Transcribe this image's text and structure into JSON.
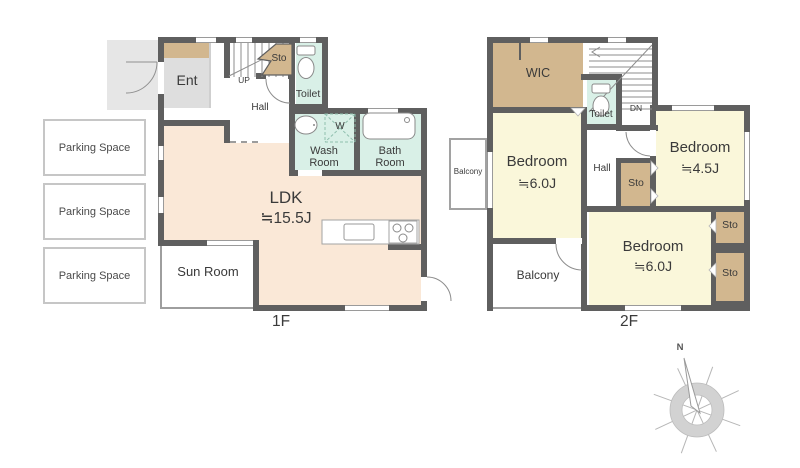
{
  "colors": {
    "wall": "#5f5f5f",
    "ldk": "#fae8d7",
    "bedroom": "#faf7da",
    "storage": "#d2b78f",
    "wet": "#d9f0e7",
    "ent": "#dedede",
    "porch": "#e6e6e6"
  },
  "floor1": {
    "label": "1F",
    "parking": [
      "Parking Space",
      "Parking Space",
      "Parking Space"
    ],
    "rooms": {
      "ent": "Ent",
      "storage": "Sto",
      "toilet": "Toilet",
      "hall": "Hall",
      "stairs_up": "UP",
      "washer": "W",
      "wash_room": "Wash\nRoom",
      "bath_room": "Bath\nRoom",
      "ldk_name": "LDK",
      "ldk_size": "≒15.5J",
      "sun_room": "Sun Room"
    }
  },
  "floor2": {
    "label": "2F",
    "rooms": {
      "wic": "WIC",
      "toilet": "Toilet",
      "stairs_down": "DN",
      "hall": "Hall",
      "storage": "Sto",
      "balcony": "Balcony",
      "bedroom1": {
        "name": "Bedroom",
        "size": "≒6.0J"
      },
      "bedroom2": {
        "name": "Bedroom",
        "size": "≒4.5J"
      },
      "bedroom3": {
        "name": "Bedroom",
        "size": "≒6.0J"
      }
    }
  },
  "compass": {
    "north": "N"
  }
}
